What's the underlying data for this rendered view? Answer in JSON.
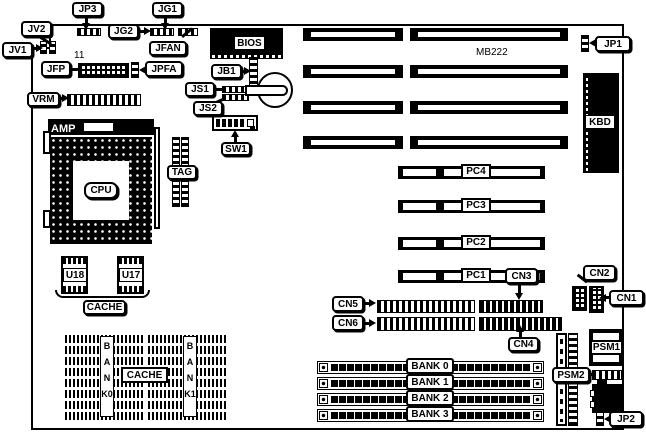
{
  "diagram": {
    "board_name": "MB222",
    "pin1_note": "11",
    "colors": {
      "line": "#000000",
      "background": "#ffffff"
    },
    "callouts": {
      "jv2": "JV2",
      "jv1": "JV1",
      "jp3": "JP3",
      "jg2": "JG2",
      "jg1": "JG1",
      "jfan": "JFAN",
      "jfp": "JFP",
      "jpfa": "JPFA",
      "vrm": "VRM",
      "jb1": "JB1",
      "js1": "JS1",
      "js2": "JS2",
      "sw1": "SW1",
      "jp1": "JP1",
      "tag": "TAG",
      "cn1": "CN1",
      "cn2": "CN2",
      "cn3": "CN3",
      "cn4": "CN4",
      "cn5": "CN5",
      "cn6": "CN6",
      "cache_sram": "CACHE",
      "cache_array": "CACHE",
      "psm1": "PSM1",
      "psm2": "PSM2",
      "jp2": "JP2"
    },
    "chips": {
      "bios": "BIOS",
      "cpu": "CPU",
      "kbd": "KBD",
      "amp": "AMP",
      "u18": "U18",
      "u17": "U17"
    },
    "slots": {
      "pci": [
        "PC1",
        "PC2",
        "PC3",
        "PC4"
      ],
      "simm_banks": [
        "BANK 0",
        "BANK 1",
        "BANK 2",
        "BANK 3"
      ],
      "cache_columns": [
        "BANK0",
        "BANK1"
      ]
    }
  }
}
